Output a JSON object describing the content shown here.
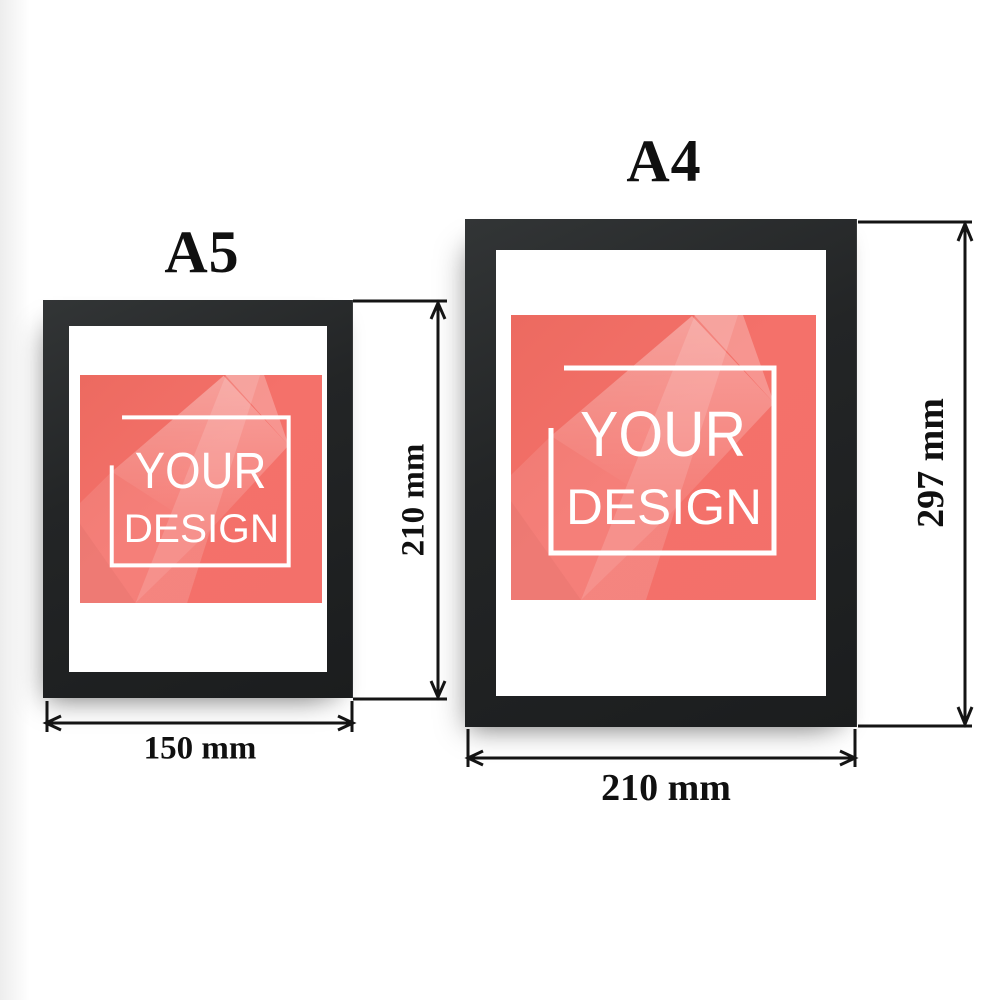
{
  "page": {
    "background": "#ffffff",
    "description_colors": {
      "frame_black": "#232526",
      "mat_white": "#ffffff",
      "poster_coral": "#f4716a",
      "poster_text_white": "#ffffff",
      "dimension_line_black": "#141414",
      "label_text_black": "#101010"
    }
  },
  "frames": [
    {
      "size_label": "A5",
      "height_label": "210 mm",
      "width_label": "150 mm",
      "poster": {
        "line1": "YOUR",
        "line2": "DESIGN"
      }
    },
    {
      "size_label": "A4",
      "height_label": "297 mm",
      "width_label": "210 mm",
      "poster": {
        "line1": "YOUR",
        "line2": "DESIGN"
      }
    }
  ]
}
